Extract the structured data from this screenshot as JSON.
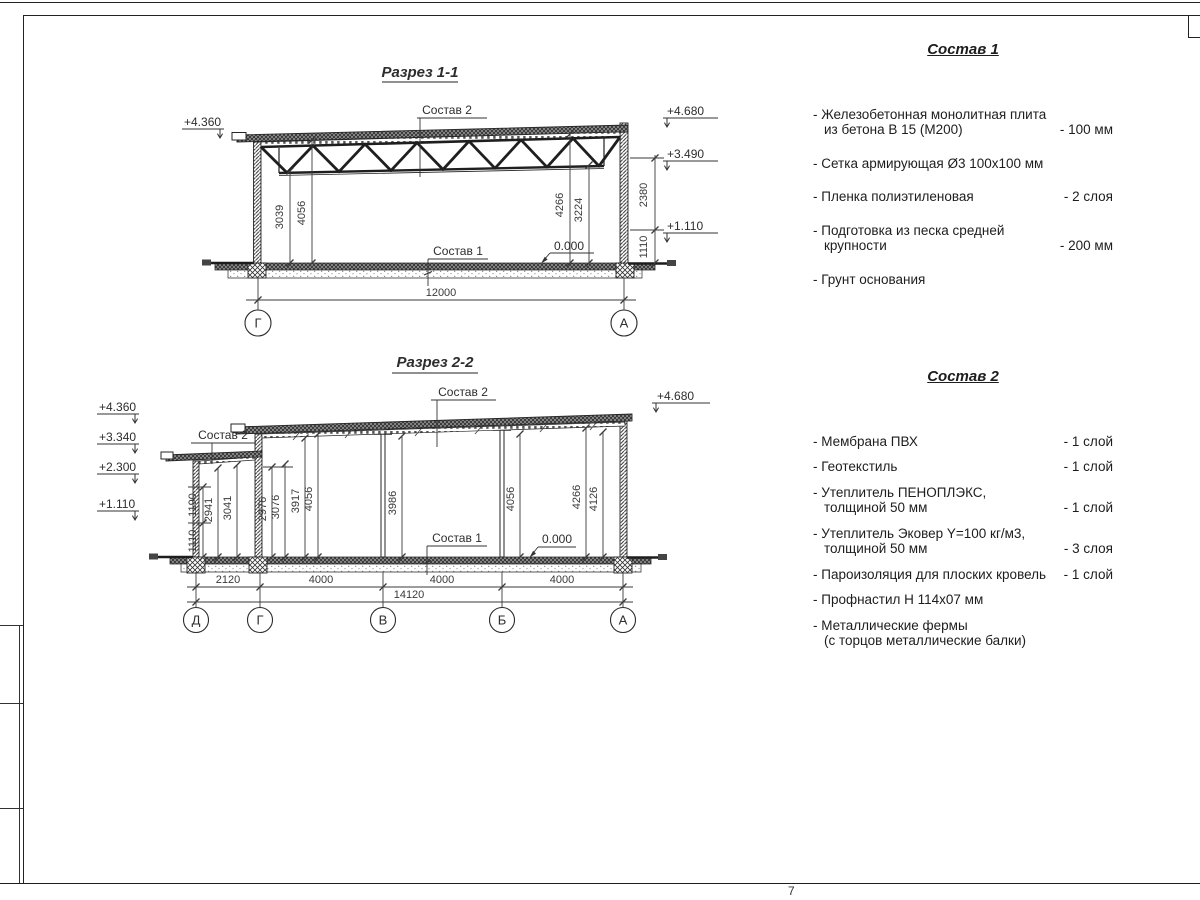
{
  "sheet": {
    "page_number": "7"
  },
  "section1": {
    "title": "Разрез 1-1",
    "labels": {
      "sostav2": "Состав 2",
      "sostav1": "Состав 1",
      "zero": "0.000"
    },
    "elev": {
      "left_top": "+4.360",
      "right_top": "+4.680",
      "right_mid": "+3.490",
      "right_low": "+1.110"
    },
    "dims": {
      "left_a": "3039",
      "left_b": "4056",
      "right_a": "4266",
      "right_b": "3224",
      "outer_a": "2380",
      "outer_b": "1110",
      "total": "12000"
    },
    "axes": {
      "left": "Г",
      "right": "А"
    }
  },
  "section2": {
    "title": "Разрез 2-2",
    "labels": {
      "sostav2_top": "Состав 2",
      "sostav2_left": "Состав 2",
      "sostav1": "Состав 1",
      "zero": "0.000"
    },
    "elev": {
      "l1": "+4.360",
      "l2": "+3.340",
      "l3": "+2.300",
      "l4": "+1.110",
      "r1": "+4.680"
    },
    "dims": {
      "annex_outer_a": "1190",
      "annex_outer_b": "1110",
      "v1": "2941",
      "v2": "3041",
      "v3": "2976",
      "v4": "3076",
      "v5": "3917",
      "v6": "4056",
      "v7": "3986",
      "v8": "4056",
      "v9": "4266",
      "v10": "4126",
      "b1": "2120",
      "b2": "4000",
      "b3": "4000",
      "b4": "4000",
      "total": "14120"
    },
    "axes": {
      "a1": "Д",
      "a2": "Г",
      "a3": "В",
      "a4": "Б",
      "a5": "А"
    }
  },
  "sostav1": {
    "title": "Состав 1",
    "items": [
      {
        "line1": "- Железобетонная  монолитная плита",
        "line2": "из бетона В 15 (М200)",
        "value": "- 100 мм"
      },
      {
        "line1": "- Сетка армирующая Ø3 100х100 мм",
        "line2": "",
        "value": ""
      },
      {
        "line1": "- Пленка полиэтиленовая",
        "line2": "",
        "value": "-  2 слоя"
      },
      {
        "line1": "- Подготовка из песка средней",
        "line2": "крупности",
        "value": "- 200 мм"
      },
      {
        "line1": "- Грунт основания",
        "line2": "",
        "value": ""
      }
    ]
  },
  "sostav2": {
    "title": "Состав 2",
    "items": [
      {
        "line1": "- Мембрана ПВХ",
        "line2": "",
        "value": "- 1 слой"
      },
      {
        "line1": "- Геотекстиль",
        "line2": "",
        "value": "- 1 слой"
      },
      {
        "line1": "- Утеплитель ПЕНОПЛЭКС,",
        "line2": "толщиной 50 мм",
        "value": "- 1 слой"
      },
      {
        "line1": "- Утеплитель Эковер Y=100 кг/м3,",
        "line2": "толщиной 50 мм",
        "value": "- 3 слоя"
      },
      {
        "line1": "- Пароизоляция для плоских кровель",
        "line2": "",
        "value": "- 1 слой"
      },
      {
        "line1": "- Профнастил Н 114х07 мм",
        "line2": "",
        "value": ""
      },
      {
        "line1": "- Металлические фермы",
        "line2": "(с торцов металлические балки)",
        "value": ""
      }
    ]
  },
  "colors": {
    "ink": "#262626",
    "paper": "#ffffff"
  }
}
